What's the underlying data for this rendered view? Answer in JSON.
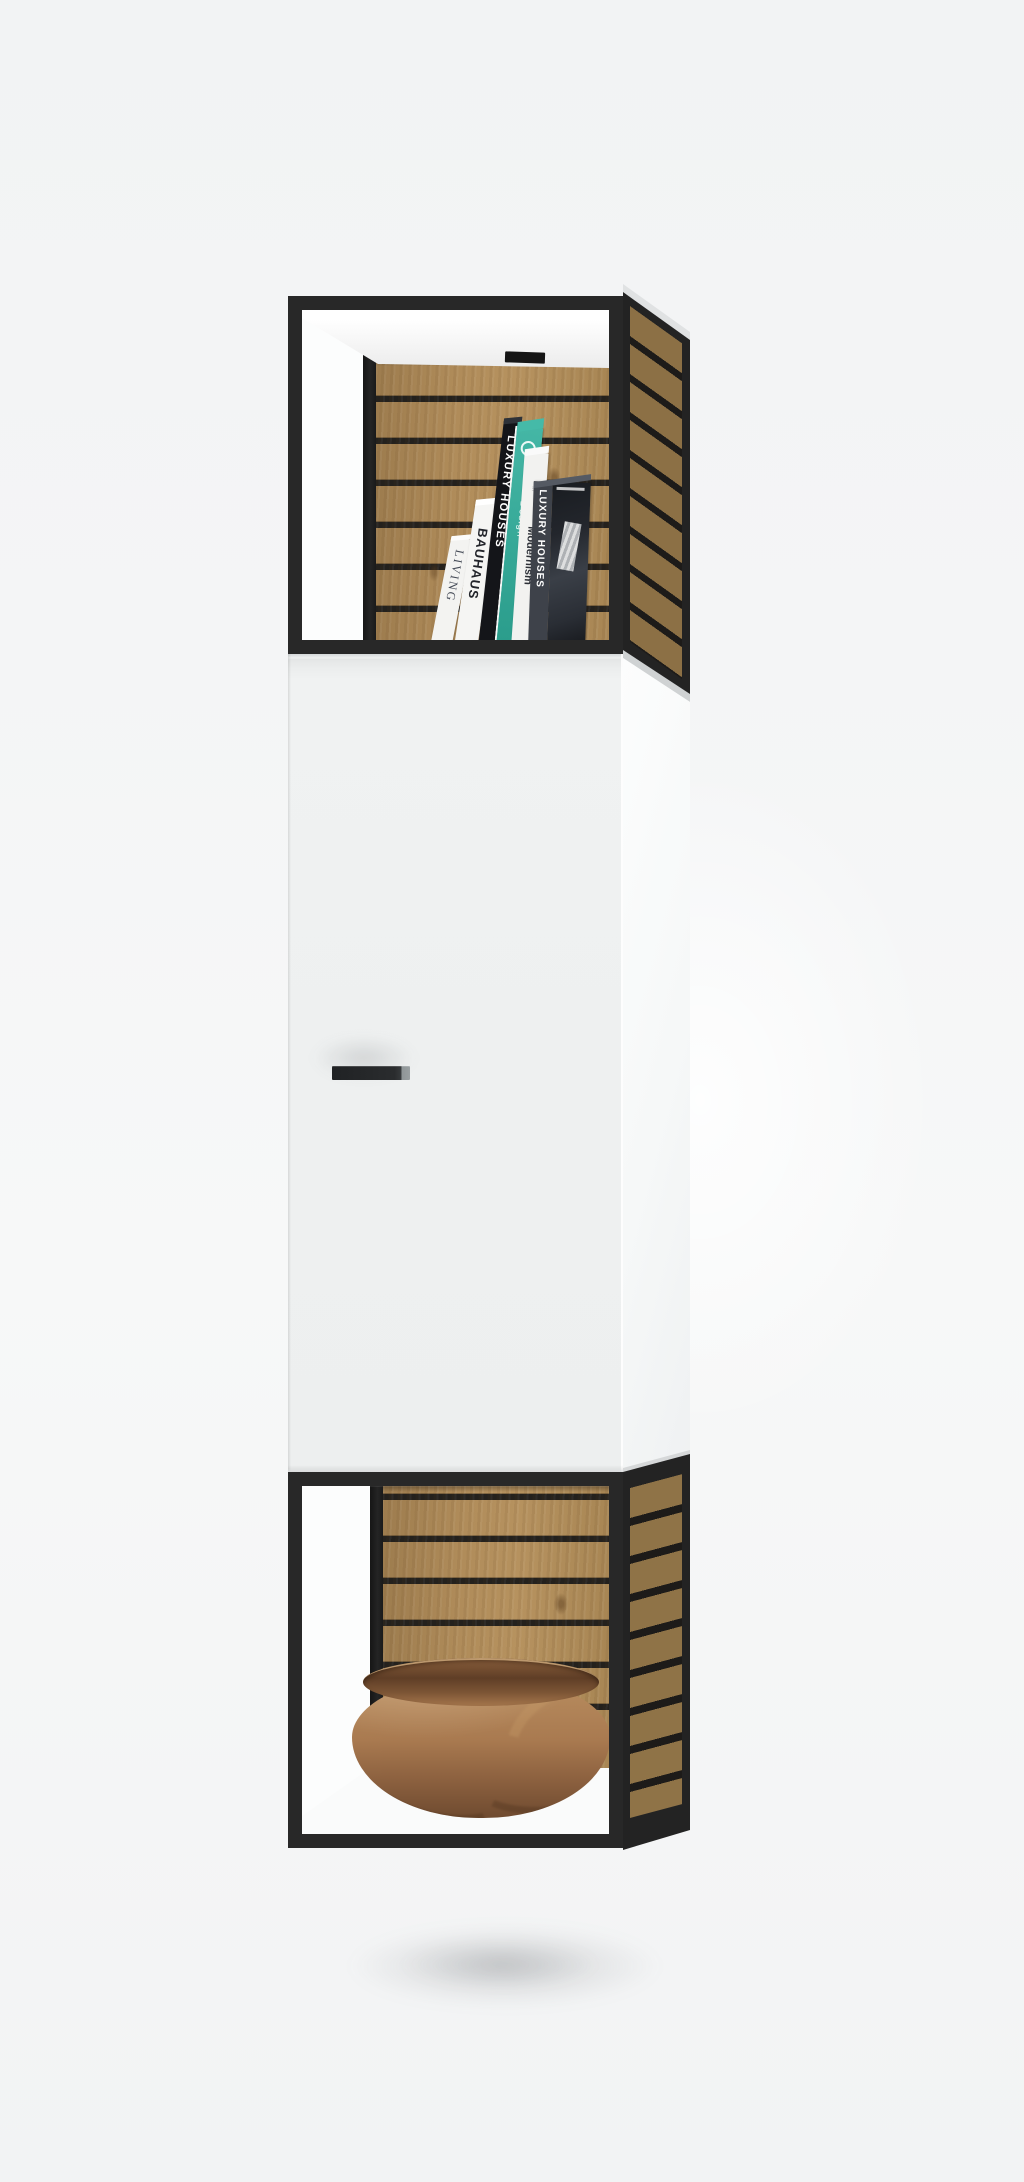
{
  "scene": {
    "description": "Wall-mounted cabinet: open black metal-frame compartments top and bottom with oak slat back panels, white door cabinet in the middle, books on the top shelf and a turned walnut bowl on the bottom shelf",
    "background_color": "#f3f4f5"
  },
  "palette": {
    "frame_black": "#282828",
    "oak_slat": "#b08c5a",
    "slat_gap": "#24211d",
    "door_white": "#f0f2f2",
    "edge_gray": "#d6d8d9",
    "teal_accent": "#2fae9b",
    "bowl_walnut": "#a97a50",
    "bowl_inner": "#5f3e26",
    "shadow": "rgba(90,95,100,0.18)"
  },
  "books": [
    {
      "title": "LIVING",
      "spine_color": "#f3f3f1",
      "text_color": "#454b57"
    },
    {
      "title": "BAUHAUS",
      "spine_color": "#f5f5f3",
      "text_color": "#22242a"
    },
    {
      "title": "LUXURY HOUSES",
      "spine_color": "#141519",
      "text_color": "#ffffff"
    },
    {
      "title": "Design",
      "spine_color": "#2fae9b",
      "text_color": "#eafaf7"
    },
    {
      "title": "Modernism",
      "spine_color": "#f2f2f0",
      "text_color": "#2e3138"
    },
    {
      "title": "LUXURY HOUSES",
      "spine_color": "#3e424a",
      "text_color": "#ffffff"
    }
  ],
  "bowl": {
    "body": "#a97a50",
    "streak": "#5c4026",
    "inner": "#5f3e26"
  }
}
